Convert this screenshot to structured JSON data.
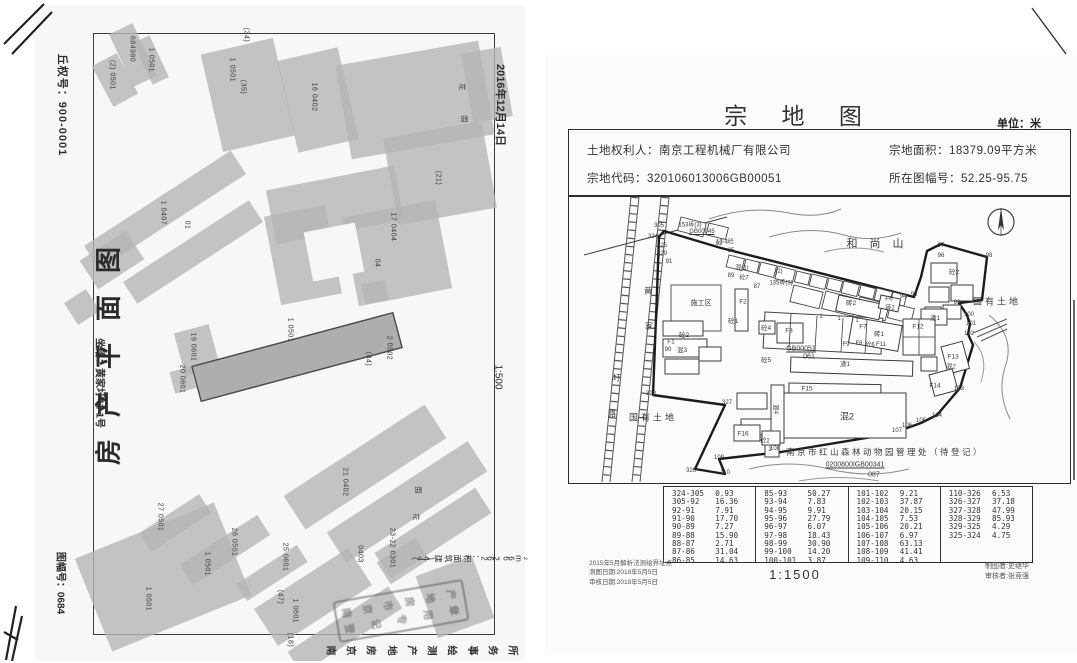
{
  "left_document": {
    "plot_number": "丘权号：900-0001",
    "title": "房产平面图",
    "location": "坐落：黄家圩41-1号",
    "sheet_number": "图幅号：0684",
    "date": "2016年12月14日",
    "scale": "1:500",
    "area_note": "(44) 建筑面积：262.66m²",
    "agency": "南京房地产测绘事务所",
    "stamp": {
      "line1": "南京市房地产",
      "line2": "登记专用章"
    },
    "building_labels": [
      {
        "t": "(2) 0501",
        "x": 77,
        "y": 70
      },
      {
        "t": "684980",
        "x": 97,
        "y": 44
      },
      {
        "t": "1 0501",
        "x": 116,
        "y": 55
      },
      {
        "t": "1 0501",
        "x": 197,
        "y": 65
      },
      {
        "t": "(34)",
        "x": 211,
        "y": 30
      },
      {
        "t": "(35)",
        "x": 208,
        "y": 82
      },
      {
        "t": "16 0402",
        "x": 279,
        "y": 92
      },
      {
        "t": "花",
        "x": 427,
        "y": 82
      },
      {
        "t": "围",
        "x": 429,
        "y": 114
      },
      {
        "t": "1 0407",
        "x": 128,
        "y": 208
      },
      {
        "t": "01",
        "x": 152,
        "y": 220
      },
      {
        "t": "(21)",
        "x": 403,
        "y": 173
      },
      {
        "t": "17 0404",
        "x": 358,
        "y": 222
      },
      {
        "t": "04",
        "x": 342,
        "y": 258
      },
      {
        "t": "1 0501",
        "x": 255,
        "y": 325
      },
      {
        "t": "(44)",
        "x": 333,
        "y": 354
      },
      {
        "t": "2 0502",
        "x": 354,
        "y": 343
      },
      {
        "t": "19 0601",
        "x": 158,
        "y": 342
      },
      {
        "t": "20 0601",
        "x": 147,
        "y": 374
      },
      {
        "t": "21 0402",
        "x": 310,
        "y": 477
      },
      {
        "t": "围",
        "x": 383,
        "y": 485
      },
      {
        "t": "花",
        "x": 381,
        "y": 512
      },
      {
        "t": "27 0501",
        "x": 125,
        "y": 512
      },
      {
        "t": "26 0501",
        "x": 199,
        "y": 537
      },
      {
        "t": "1 0501",
        "x": 172,
        "y": 559
      },
      {
        "t": "25 0601",
        "x": 250,
        "y": 552
      },
      {
        "t": "(47)",
        "x": 245,
        "y": 592
      },
      {
        "t": "1 0601",
        "x": 260,
        "y": 606
      },
      {
        "t": "(18)",
        "x": 255,
        "y": 635
      },
      {
        "t": "0403",
        "x": 325,
        "y": 549
      },
      {
        "t": "23-22 0301",
        "x": 357,
        "y": 543
      },
      {
        "t": "1 0501",
        "x": 113,
        "y": 594
      }
    ]
  },
  "right_document": {
    "title": "宗 地 图",
    "unit": "单位：米",
    "owner": "土地权利人：南京工程机械厂有限公司",
    "parcel_code": "宗地代码：320106013006GB00051",
    "parcel_area": "宗地面积：18379.09平方米",
    "sheet_number": "所在图幅号：52.25-95.75",
    "scale": "1:1500",
    "notes_left": [
      "2015年5月解析法测绘界址点",
      "测图日期:2018年5月5日",
      "审核日期:2018年5月5日"
    ],
    "notes_right": [
      "制图者:史继华",
      "审核者:张竞强"
    ],
    "map_labels": [
      {
        "t": "和尚山",
        "x": 312,
        "y": 46,
        "s": 11,
        "ls": 12
      },
      {
        "t": "国有土地",
        "x": 428,
        "y": 104,
        "s": 9,
        "ls": 3
      },
      {
        "t": "国有土地",
        "x": 84,
        "y": 220,
        "s": 9,
        "ls": 3
      },
      {
        "t": "施工区",
        "x": 132,
        "y": 106,
        "s": 7
      },
      {
        "t": "黄",
        "x": 79,
        "y": 94,
        "s": 8
      },
      {
        "t": "家",
        "x": 80,
        "y": 129,
        "s": 8
      },
      {
        "t": "圩",
        "x": 48,
        "y": 181,
        "s": 8
      },
      {
        "t": "路",
        "x": 43,
        "y": 217,
        "s": 8
      },
      {
        "t": "305",
        "x": 90,
        "y": 29,
        "s": 6
      },
      {
        "t": "324",
        "x": 84,
        "y": 40,
        "s": 6
      },
      {
        "t": "325",
        "x": 93,
        "y": 49,
        "s": 6
      },
      {
        "t": "329",
        "x": 93,
        "y": 57,
        "s": 6
      },
      {
        "t": "91",
        "x": 100,
        "y": 65,
        "s": 6
      },
      {
        "t": "92",
        "x": 150,
        "y": 47,
        "s": 6
      },
      {
        "t": "85",
        "x": 162,
        "y": 54,
        "s": 6
      },
      {
        "t": "153砖(3)",
        "x": 121,
        "y": 27,
        "s": 6
      },
      {
        "t": "GB00045",
        "x": 133,
        "y": 35,
        "s": 6,
        "u": 1
      },
      {
        "t": "13-4砼",
        "x": 156,
        "y": 44,
        "s": 6
      },
      {
        "t": "混(1)",
        "x": 173,
        "y": 70,
        "s": 6
      },
      {
        "t": "89",
        "x": 162,
        "y": 79,
        "s": 6
      },
      {
        "t": "砼7",
        "x": 175,
        "y": 80,
        "s": 6
      },
      {
        "t": "(2)",
        "x": 210,
        "y": 75,
        "s": 6
      },
      {
        "t": "135砖(3)",
        "x": 212,
        "y": 85,
        "s": 6
      },
      {
        "t": "87",
        "x": 188,
        "y": 90,
        "s": 6
      },
      {
        "t": "1",
        "x": 252,
        "y": 120,
        "s": 6
      },
      {
        "t": "1",
        "x": 270,
        "y": 122,
        "s": 6
      },
      {
        "t": "1",
        "x": 288,
        "y": 124,
        "s": 6
      },
      {
        "t": "93",
        "x": 345,
        "y": 98,
        "s": 6
      },
      {
        "t": "94",
        "x": 334,
        "y": 100,
        "s": 6
      },
      {
        "t": "97",
        "x": 372,
        "y": 49,
        "s": 6
      },
      {
        "t": "96",
        "x": 372,
        "y": 59,
        "s": 6
      },
      {
        "t": "98",
        "x": 420,
        "y": 59,
        "s": 6
      },
      {
        "t": "砼2",
        "x": 385,
        "y": 74,
        "s": 6.5
      },
      {
        "t": "99",
        "x": 388,
        "y": 106,
        "s": 6
      },
      {
        "t": "100",
        "x": 400,
        "y": 118,
        "s": 6
      },
      {
        "t": "101",
        "x": 402,
        "y": 127,
        "s": 6
      },
      {
        "t": "102",
        "x": 400,
        "y": 137,
        "s": 6
      },
      {
        "t": "103",
        "x": 390,
        "y": 192,
        "s": 6
      },
      {
        "t": "104",
        "x": 368,
        "y": 219,
        "s": 6
      },
      {
        "t": "105",
        "x": 352,
        "y": 224,
        "s": 6
      },
      {
        "t": "106",
        "x": 338,
        "y": 229,
        "s": 6
      },
      {
        "t": "107",
        "x": 328,
        "y": 234,
        "s": 6
      },
      {
        "t": "108",
        "x": 206,
        "y": 252,
        "s": 6
      },
      {
        "t": "109",
        "x": 150,
        "y": 261,
        "s": 6
      },
      {
        "t": "110",
        "x": 156,
        "y": 276,
        "s": 6
      },
      {
        "t": "326",
        "x": 122,
        "y": 274,
        "s": 6
      },
      {
        "t": "327",
        "x": 158,
        "y": 206,
        "s": 6
      },
      {
        "t": "328",
        "x": 82,
        "y": 197,
        "s": 6
      },
      {
        "t": "F2",
        "x": 174,
        "y": 105,
        "s": 6.5
      },
      {
        "t": "砼1",
        "x": 164,
        "y": 123,
        "s": 6.5
      },
      {
        "t": "砼2",
        "x": 115,
        "y": 137,
        "s": 6.5
      },
      {
        "t": "F1",
        "x": 102,
        "y": 145,
        "s": 6.5
      },
      {
        "t": "混3",
        "x": 113,
        "y": 152,
        "s": 6.5
      },
      {
        "t": "90",
        "x": 99,
        "y": 153,
        "s": 6
      },
      {
        "t": "砼4",
        "x": 197,
        "y": 130,
        "s": 6.5
      },
      {
        "t": "F3",
        "x": 220,
        "y": 134,
        "s": 6.5
      },
      {
        "t": "砼5",
        "x": 197,
        "y": 162,
        "s": 6.5
      },
      {
        "t": "GB00051",
        "x": 232,
        "y": 152,
        "s": 7,
        "u": 1
      },
      {
        "t": "061",
        "x": 240,
        "y": 160,
        "s": 7
      },
      {
        "t": "渣1",
        "x": 276,
        "y": 166,
        "s": 6.5
      },
      {
        "t": "F15",
        "x": 238,
        "y": 192,
        "s": 6.5
      },
      {
        "t": "混4",
        "x": 208,
        "y": 212,
        "s": 6.5,
        "r": 90
      },
      {
        "t": "混2",
        "x": 278,
        "y": 219,
        "s": 9
      },
      {
        "t": "F16",
        "x": 174,
        "y": 237,
        "s": 6.5
      },
      {
        "t": "砼2",
        "x": 196,
        "y": 243,
        "s": 6
      },
      {
        "t": "2",
        "x": 201,
        "y": 253,
        "s": 6
      },
      {
        "t": "砖2",
        "x": 282,
        "y": 105,
        "s": 6.5
      },
      {
        "t": "F6",
        "x": 320,
        "y": 102,
        "s": 6.5
      },
      {
        "t": "砖2",
        "x": 321,
        "y": 110,
        "s": 6
      },
      {
        "t": "F7",
        "x": 294,
        "y": 130,
        "s": 6.5
      },
      {
        "t": "砖1",
        "x": 310,
        "y": 136,
        "s": 6.5
      },
      {
        "t": "F12",
        "x": 349,
        "y": 130,
        "s": 6.5
      },
      {
        "t": "渣1",
        "x": 366,
        "y": 120,
        "s": 6.5
      },
      {
        "t": "F9",
        "x": 277,
        "y": 148,
        "s": 6
      },
      {
        "t": "F8",
        "x": 290,
        "y": 147,
        "s": 6
      },
      {
        "t": "砼6",
        "x": 301,
        "y": 147,
        "s": 6
      },
      {
        "t": "F11",
        "x": 312,
        "y": 148,
        "s": 6
      },
      {
        "t": "F13",
        "x": 384,
        "y": 160,
        "s": 6.5
      },
      {
        "t": "混2",
        "x": 382,
        "y": 169,
        "s": 6
      },
      {
        "t": "F14",
        "x": 366,
        "y": 189,
        "s": 6.5
      },
      {
        "t": "南京市红山森林动物园管理处（待登记）",
        "x": 316,
        "y": 255,
        "s": 8.5,
        "ls": 2.5
      },
      {
        "t": "0200800IGB00341",
        "x": 286,
        "y": 268,
        "s": 7,
        "u": 1
      },
      {
        "t": "087",
        "x": 305,
        "y": 278,
        "s": 7
      }
    ],
    "segment_table": [
      [
        [
          "324-305",
          "0.93"
        ],
        [
          "305-92",
          "16.36"
        ],
        [
          "92-91",
          "7.91"
        ],
        [
          "91-90",
          "17.70"
        ],
        [
          "90-89",
          "7.27"
        ],
        [
          "89-88",
          "15.90"
        ],
        [
          "88-87",
          "2.71"
        ],
        [
          "87-86",
          "31.04"
        ],
        [
          "86-85",
          "14.63"
        ]
      ],
      [
        [
          "85-93",
          "50.27"
        ],
        [
          "93-94",
          "7.83"
        ],
        [
          "94-95",
          "9.91"
        ],
        [
          "95-96",
          "27.79"
        ],
        [
          "96-97",
          "6.07"
        ],
        [
          "97-98",
          "18.43"
        ],
        [
          "98-99",
          "30.90"
        ],
        [
          "99-100",
          "14.20"
        ],
        [
          "100-101",
          "3.87"
        ]
      ],
      [
        [
          "101-102",
          "9.21"
        ],
        [
          "102-103",
          "37.87"
        ],
        [
          "103-104",
          "20.15"
        ],
        [
          "104-105",
          "7.53"
        ],
        [
          "105-106",
          "20.21"
        ],
        [
          "106-107",
          "6.97"
        ],
        [
          "107-108",
          "63.13"
        ],
        [
          "108-109",
          "41.41"
        ],
        [
          "109-110",
          "4.63"
        ]
      ],
      [
        [
          "110-326",
          "6.53"
        ],
        [
          "326-327",
          "37.18"
        ],
        [
          "327-328",
          "47.99"
        ],
        [
          "328-329",
          "85.93"
        ],
        [
          "329-325",
          "4.29"
        ],
        [
          "325-324",
          "4.75"
        ]
      ]
    ]
  }
}
